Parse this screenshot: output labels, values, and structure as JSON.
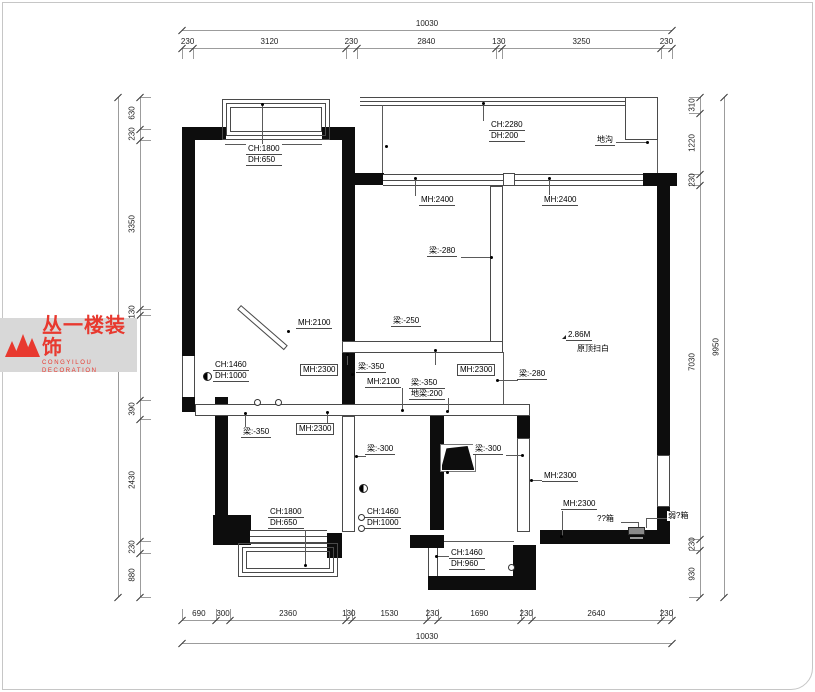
{
  "brand": {
    "name_cn": "丛一楼装饰",
    "name_en": "CONGYILOU DECORATION",
    "accent_color": "#e8392f"
  },
  "dimensions": {
    "top": {
      "total": "10030",
      "segments": [
        "230",
        "3120",
        "230",
        "2840",
        "130",
        "3250",
        "230"
      ]
    },
    "bottom": {
      "total": "10030",
      "segments": [
        "690",
        "300",
        "2360",
        "130",
        "1530",
        "230",
        "1690",
        "230",
        "2640",
        "230"
      ]
    },
    "left": {
      "segments": [
        "630",
        "230",
        "3350",
        "130",
        "1680",
        "390",
        "2430",
        "230",
        "880"
      ]
    },
    "right": {
      "total": "9950",
      "segments": [
        "310",
        "1220",
        "230",
        "7030",
        "230",
        "930"
      ]
    }
  },
  "labels": {
    "bay_tl": {
      "line1": "CH:1800",
      "line2": "DH:650"
    },
    "balcony_sill": {
      "line1": "CH:2280",
      "line2": "DH:200"
    },
    "digou": {
      "text": "地沟"
    },
    "mh2400_l": {
      "text": "MH:2400"
    },
    "mh2400_r": {
      "text": "MH:2400"
    },
    "beam280_top": {
      "text": "梁:-280"
    },
    "beam250": {
      "text": "梁:-250"
    },
    "mh2100_diag": {
      "text": "MH:2100"
    },
    "win_left": {
      "line1": "CH:1460",
      "line2": "DH:1000"
    },
    "mh2300_k1": {
      "text": "MH:2300"
    },
    "beam350_a": {
      "text": "梁:-350"
    },
    "mh2300_k2": {
      "text": "MH:2300"
    },
    "mh2100_k": {
      "text": "MH:2100"
    },
    "beam350_floor": {
      "line1": "梁:-350",
      "line2": "地梁:200"
    },
    "beam280_r": {
      "text": "梁:-280"
    },
    "note_elev": {
      "text": "2.86M"
    },
    "note_paint": {
      "text": "原顶扫白"
    },
    "beam350_b": {
      "text": "梁:-350"
    },
    "mh2300_bl": {
      "text": "MH:2300"
    },
    "beam300_l": {
      "text": "梁:-300"
    },
    "beam300_r": {
      "text": "梁:-300"
    },
    "mh2300_r1": {
      "text": "MH:2300"
    },
    "mh2300_r2": {
      "text": "MH:2300"
    },
    "box_strong": {
      "text": "??箱"
    },
    "box_weak": {
      "text": "弱?箱"
    },
    "win_bm": {
      "line1": "CH:1460",
      "line2": "DH:1000"
    },
    "bay_bl": {
      "line1": "CH:1800",
      "line2": "DH:650"
    },
    "win_b960": {
      "line1": "CH:1460",
      "line2": "DH:960"
    }
  }
}
